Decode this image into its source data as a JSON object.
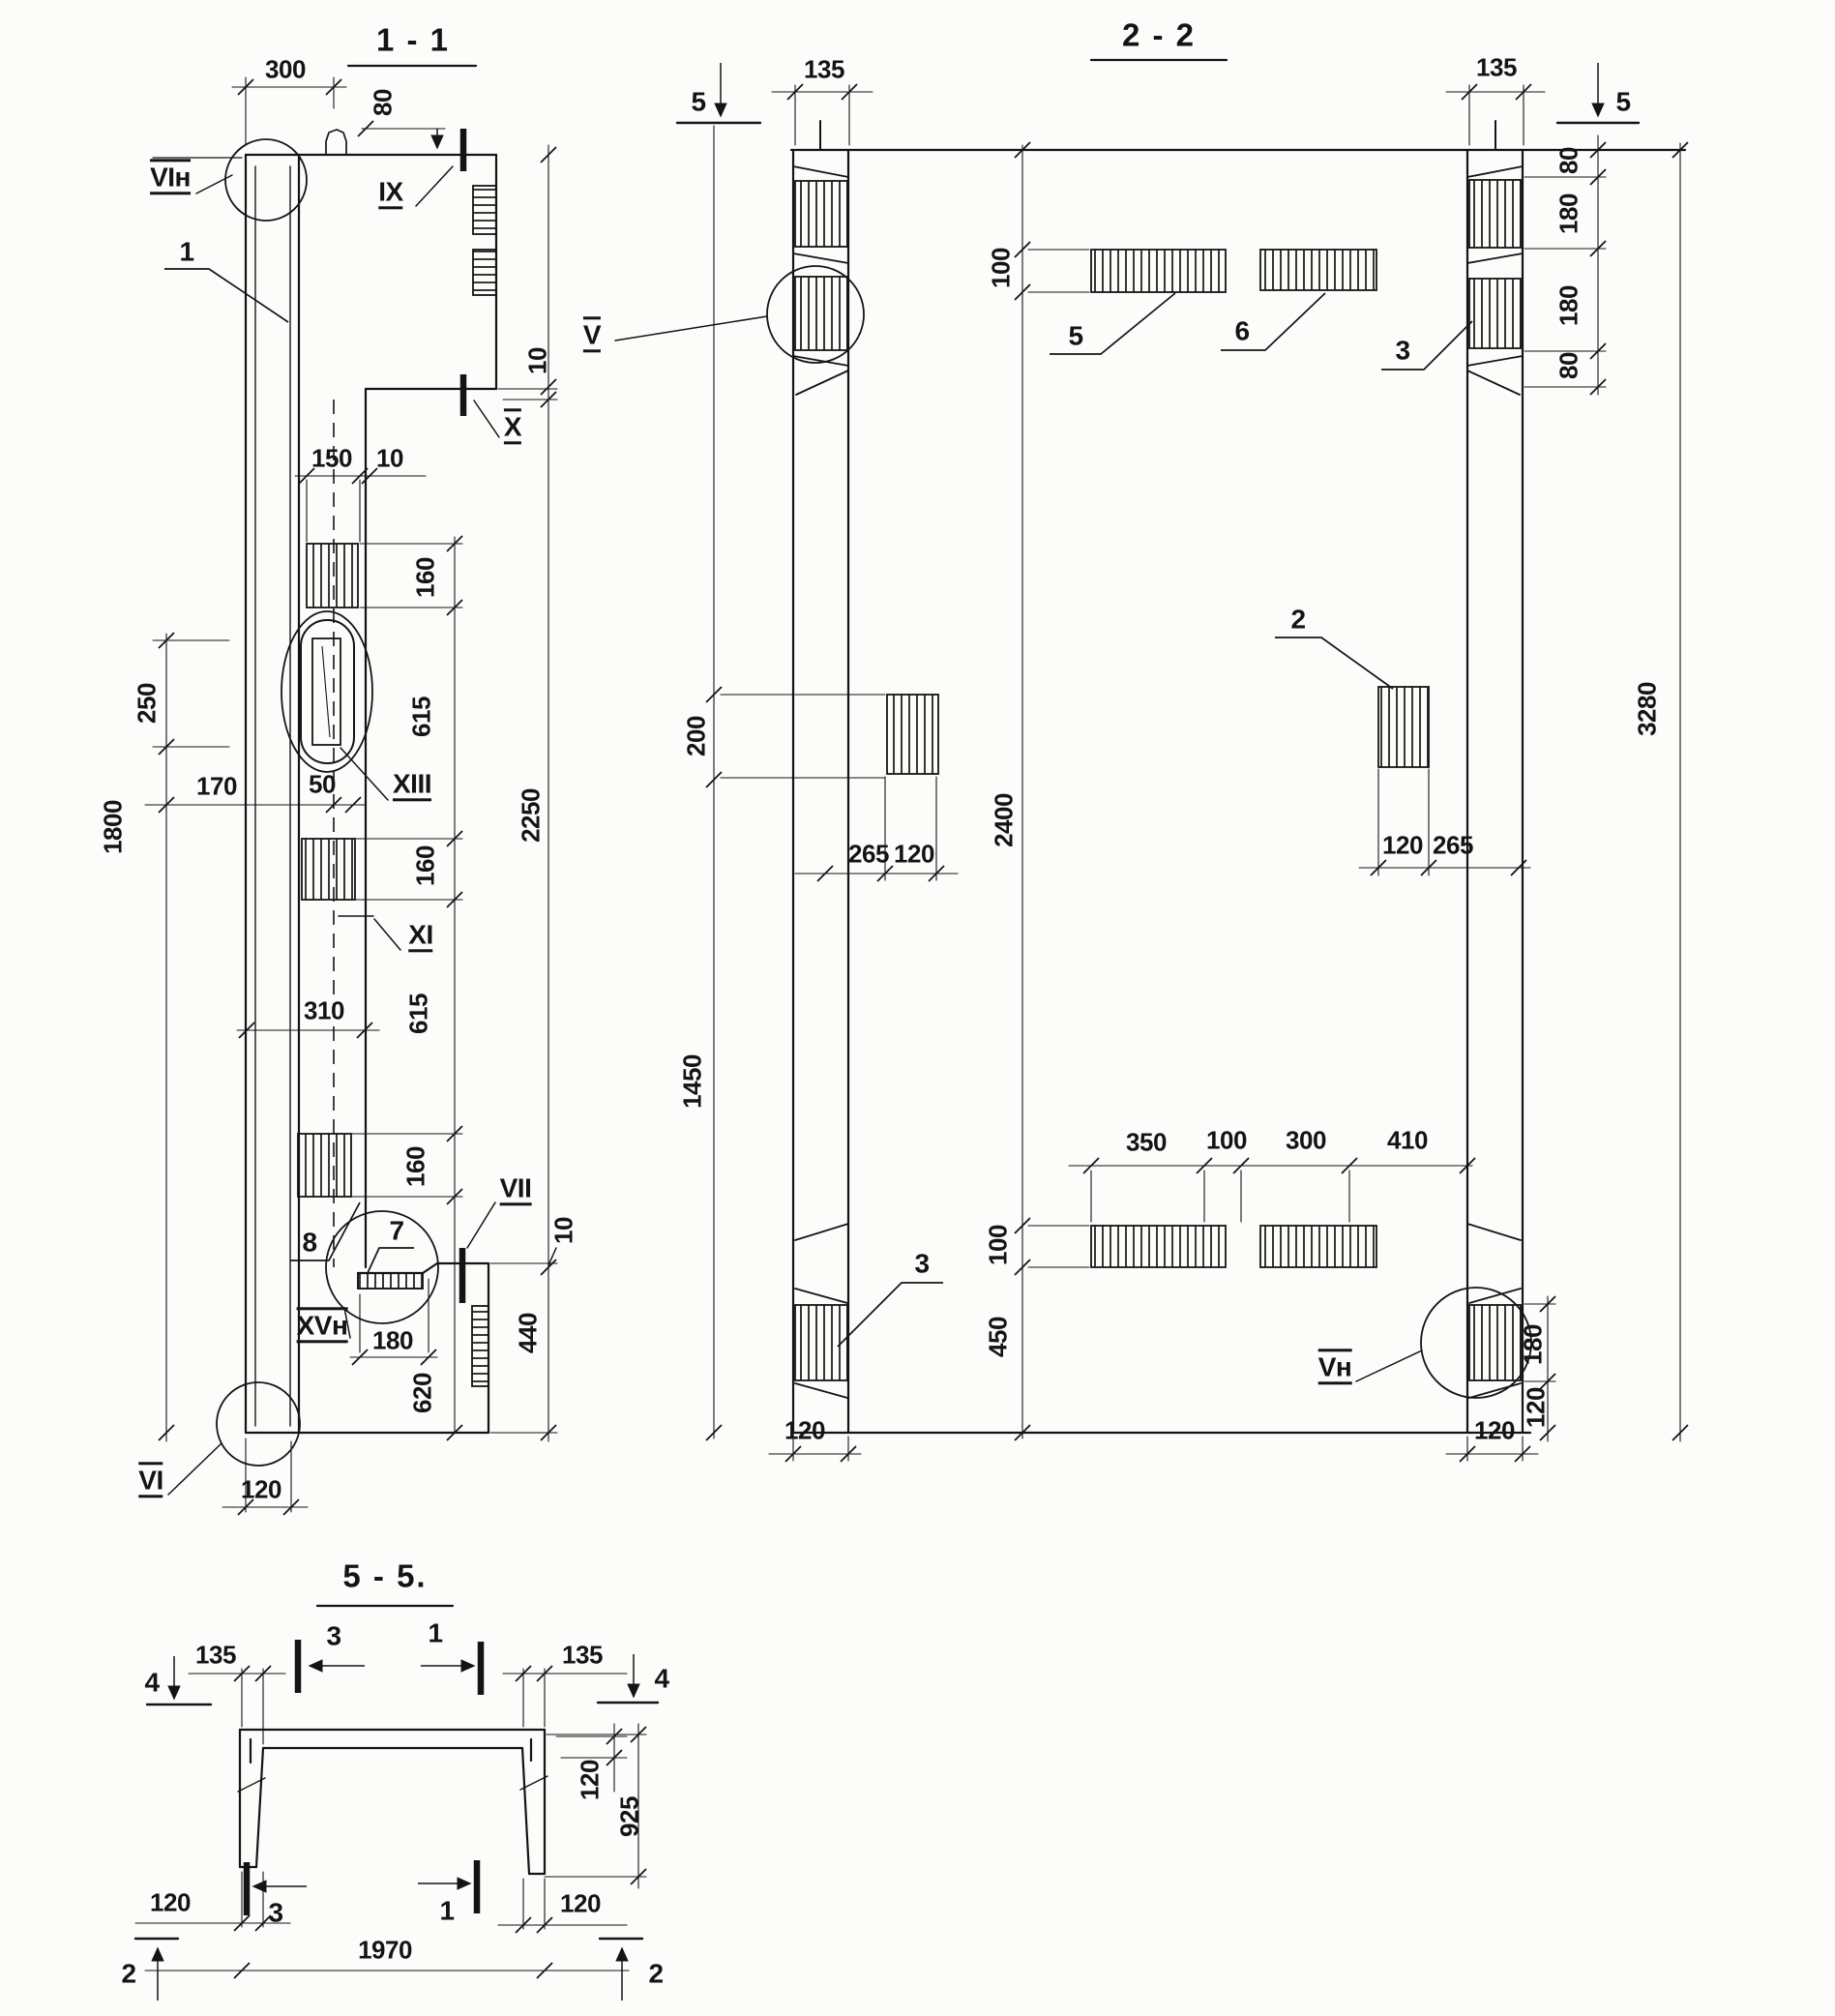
{
  "drawing": {
    "view_1_1": {
      "title": "1 - 1",
      "detail_labels": {
        "vi_n": "VIн",
        "one": "1",
        "ix": "IX",
        "x": "X",
        "xiii": "XIII",
        "xi": "XI",
        "vii": "VII",
        "xv_n": "XVн",
        "vi": "VI",
        "seven": "7",
        "eight": "8"
      },
      "dims": {
        "d300": "300",
        "d80": "80",
        "d10_top": "10",
        "d150": "150",
        "d10_gap": "10",
        "d160_1": "160",
        "d615_1": "615",
        "d250": "250",
        "d170": "170",
        "d50": "50",
        "d160_2": "160",
        "d2250": "2250",
        "d615_2": "615",
        "d310": "310",
        "d160_3": "160",
        "d10_step": "10",
        "d180": "180",
        "d440": "440",
        "d620": "620",
        "d1800": "1800",
        "d120": "120"
      }
    },
    "view_2_2": {
      "title": "2 - 2",
      "section_marks": {
        "s5_left": "5",
        "s5_right": "5"
      },
      "detail_labels": {
        "v": "V",
        "v_n": "Vн",
        "item2": "2",
        "item3_top": "3",
        "item3_bot": "3",
        "item5": "5",
        "item6": "6"
      },
      "dims": {
        "d135_l": "135",
        "d135_r": "135",
        "d80_t1": "80",
        "d180_t1": "180",
        "d180_t2": "180",
        "d80_t2": "80",
        "d3280": "3280",
        "d100_top": "100",
        "d200": "200",
        "d2400": "2400",
        "d265_l": "265",
        "d120_l": "120",
        "d120_r": "120",
        "d265_r": "265",
        "d1450": "1450",
        "d100_bot": "100",
        "d450": "450",
        "d350": "350",
        "d100_c": "100",
        "d300": "300",
        "d410": "410",
        "d180_br": "180",
        "d120_br": "120",
        "d120_bot_l": "120",
        "d120_bot_r": "120"
      }
    },
    "view_5_5": {
      "title": "5 - 5.",
      "section_marks": {
        "s4_left": "4",
        "s4_right": "4",
        "s3_top": "3",
        "s1_top": "1",
        "s3_bot": "3",
        "s1_bot": "1",
        "s2_left": "2",
        "s2_right": "2"
      },
      "dims": {
        "d135_l": "135",
        "d135_r": "135",
        "d120_flange": "120",
        "d925": "925",
        "d120_bl": "120",
        "d120_br": "120",
        "d1970": "1970"
      }
    }
  }
}
